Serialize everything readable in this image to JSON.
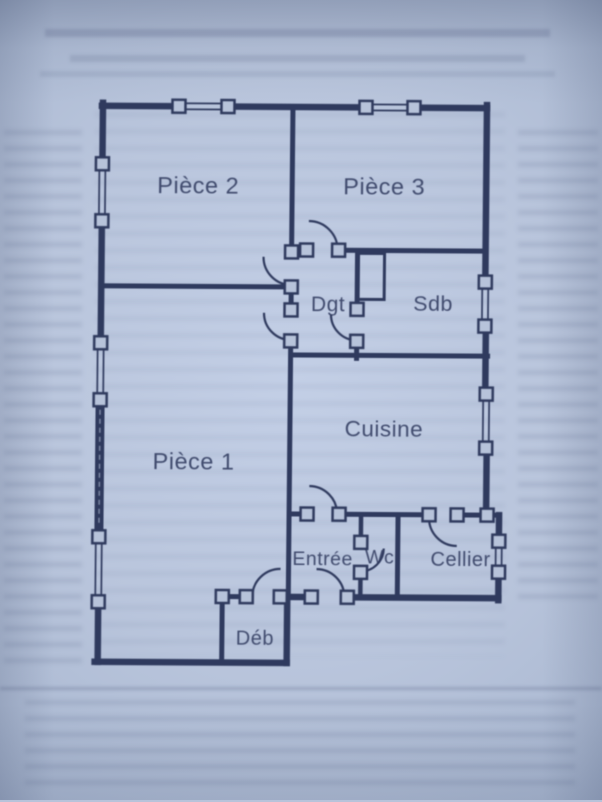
{
  "palette": {
    "paper": "#b7c3da",
    "paper_bright": "#c3cfe6",
    "ink": "#2f3a5e",
    "shadow": "#8090b1"
  },
  "plan": {
    "rooms": [
      {
        "id": "piece2",
        "label": "Pièce 2"
      },
      {
        "id": "piece3",
        "label": "Pièce 3"
      },
      {
        "id": "dgt",
        "label": "Dgt"
      },
      {
        "id": "sdb",
        "label": "Sdb"
      },
      {
        "id": "cuisine",
        "label": "Cuisine"
      },
      {
        "id": "piece1",
        "label": "Pièce 1"
      },
      {
        "id": "entree",
        "label": "Entrée"
      },
      {
        "id": "wc",
        "label": "Wc"
      },
      {
        "id": "cellier",
        "label": "Cellier"
      },
      {
        "id": "deb",
        "label": "Déb"
      }
    ]
  }
}
